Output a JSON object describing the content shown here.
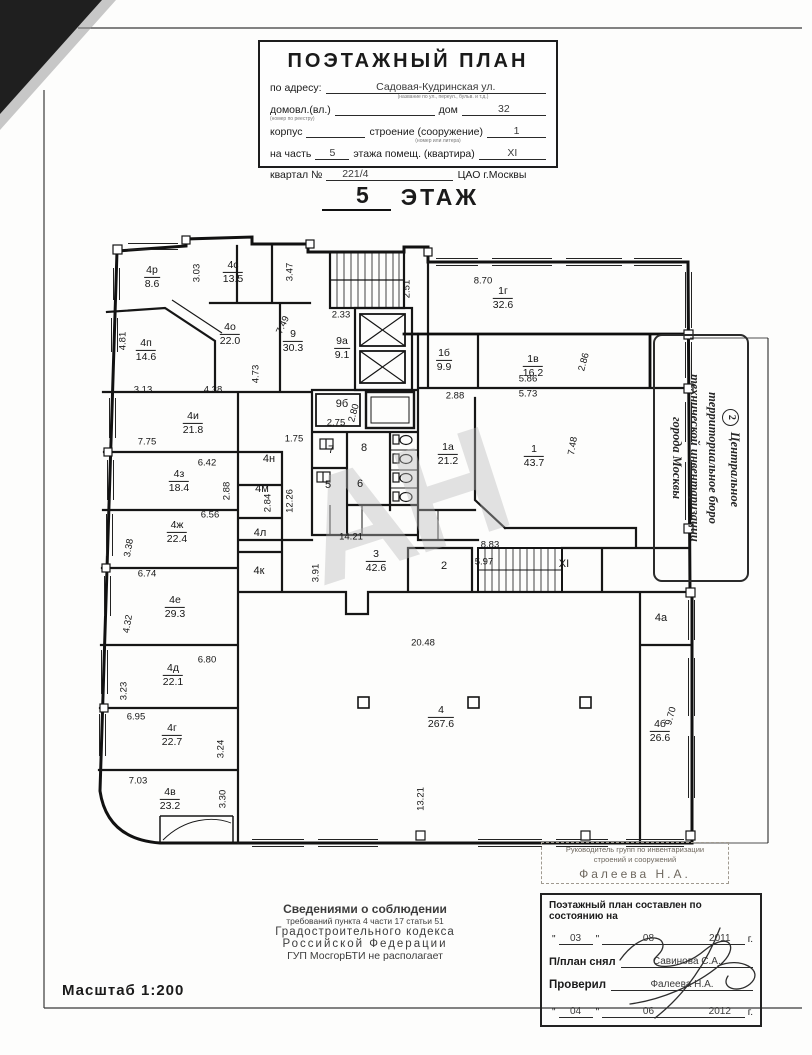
{
  "header": {
    "title": "ПОЭТАЖНЫЙ ПЛАН",
    "address_label": "по адресу:",
    "address_value": "Садовая-Кудринская ул.",
    "note1": "(название по ул., переул., бульв. и т.д.)",
    "row2_label1": "домовл.(вл.)",
    "note2": "(номер по реестру)",
    "row2_label2": "дом",
    "row2_value": "32",
    "row3_label1": "корпус",
    "row3_label2": "строение (сооружение)",
    "row3_value": "1",
    "note3": "(номер или литера)",
    "row4_label1": "на часть",
    "row4_value1": "5",
    "row4_label2": "этажа помещ. (квартира)",
    "row4_value2": "XI",
    "row5_label1": "квартал №",
    "row5_value1": "221/4",
    "row5_value2": "ЦАО г.Москвы"
  },
  "floor_title": {
    "num": "5",
    "word": "ЭТАЖ"
  },
  "stamp_right": {
    "number": "2",
    "line1": "Центральное",
    "line2": "территориальное бюро",
    "line3": "технической инвентаризации",
    "line4": "города Москвы"
  },
  "note": {
    "line1": "Сведениями о соблюдении",
    "line2": "требований пункта 4 части 17 статьи 51",
    "line3": "Градостроительного кодекса",
    "line4": "Российской Федерации",
    "line5": "ГУП МосгорБТИ не располагает"
  },
  "stamp_small": {
    "line1": "Руководитель групп по инвентаризации",
    "line2": "строений и сооружений",
    "line3": "Фалеева Н.А."
  },
  "sign_box": {
    "title": "Поэтажный план составлен по состоянию на",
    "q": "\"",
    "date1_day": "03",
    "date1_month": "08",
    "date1_year": "2011",
    "date1_suffix": "г.",
    "row1_label": "П/план снял",
    "row1_value": "Савинова С.А.",
    "row2_label": "Проверил",
    "row2_value": "Фалеева Н.А.",
    "date2_day": "04",
    "date2_month": "06",
    "date2_year": "2012",
    "date2_suffix": "г."
  },
  "scale_label": "Масштаб 1:200",
  "plan": {
    "watermark": "АН",
    "rooms": [
      {
        "id": "4р",
        "area": "8.6",
        "x": 152,
        "y": 277
      },
      {
        "id": "4с",
        "area": "13.5",
        "x": 233,
        "y": 272
      },
      {
        "id": "4п",
        "area": "14.6",
        "x": 146,
        "y": 350
      },
      {
        "id": "4о",
        "area": "22.0",
        "x": 230,
        "y": 334
      },
      {
        "id": "9",
        "area": "30.3",
        "x": 293,
        "y": 341
      },
      {
        "id": "9а",
        "area": "9.1",
        "x": 342,
        "y": 348
      },
      {
        "id": "1г",
        "area": "32.6",
        "x": 503,
        "y": 298
      },
      {
        "id": "1б",
        "area": "9.9",
        "x": 444,
        "y": 360
      },
      {
        "id": "1в",
        "area": "16.2",
        "x": 533,
        "y": 366
      },
      {
        "id": "4и",
        "area": "21.8",
        "x": 193,
        "y": 423
      },
      {
        "id": "1а",
        "area": "21.2",
        "x": 448,
        "y": 454
      },
      {
        "id": "1",
        "area": "43.7",
        "x": 534,
        "y": 456
      },
      {
        "id": "4з",
        "area": "18.4",
        "x": 179,
        "y": 481
      },
      {
        "id": "4ж",
        "area": "22.4",
        "x": 177,
        "y": 532
      },
      {
        "id": "3",
        "area": "42.6",
        "x": 376,
        "y": 561
      },
      {
        "id": "4е",
        "area": "29.3",
        "x": 175,
        "y": 607
      },
      {
        "id": "4д",
        "area": "22.1",
        "x": 173,
        "y": 675
      },
      {
        "id": "4г",
        "area": "22.7",
        "x": 172,
        "y": 735
      },
      {
        "id": "4в",
        "area": "23.2",
        "x": 170,
        "y": 799
      },
      {
        "id": "4",
        "area": "267.6",
        "x": 441,
        "y": 717
      },
      {
        "id": "4б",
        "area": "26.6",
        "x": 660,
        "y": 731
      }
    ],
    "labels": [
      {
        "text": "4н",
        "x": 269,
        "y": 459
      },
      {
        "text": "4м",
        "x": 262,
        "y": 489
      },
      {
        "text": "4л",
        "x": 260,
        "y": 533
      },
      {
        "text": "4к",
        "x": 259,
        "y": 571
      },
      {
        "text": "9б",
        "x": 342,
        "y": 404
      },
      {
        "text": "7",
        "x": 331,
        "y": 450
      },
      {
        "text": "8",
        "x": 364,
        "y": 448
      },
      {
        "text": "5",
        "x": 328,
        "y": 485
      },
      {
        "text": "6",
        "x": 360,
        "y": 484
      },
      {
        "text": "2",
        "x": 444,
        "y": 566
      },
      {
        "text": "XI",
        "x": 564,
        "y": 564
      },
      {
        "text": "4а",
        "x": 661,
        "y": 618
      }
    ],
    "dims": [
      {
        "text": "3.03",
        "x": 197,
        "y": 273,
        "rot": -90
      },
      {
        "text": "3.47",
        "x": 290,
        "y": 272,
        "rot": -90
      },
      {
        "text": "2.51",
        "x": 407,
        "y": 289,
        "rot": -90
      },
      {
        "text": "8.70",
        "x": 483,
        "y": 281,
        "rot": 0
      },
      {
        "text": "2.33",
        "x": 341,
        "y": 315,
        "rot": 0
      },
      {
        "text": "7.49",
        "x": 283,
        "y": 325,
        "rot": -65
      },
      {
        "text": "4.81",
        "x": 123,
        "y": 341,
        "rot": -90
      },
      {
        "text": "3.13",
        "x": 143,
        "y": 390,
        "rot": 0
      },
      {
        "text": "4.38",
        "x": 213,
        "y": 390,
        "rot": 0
      },
      {
        "text": "4.73",
        "x": 256,
        "y": 374,
        "rot": -90
      },
      {
        "text": "2.86",
        "x": 584,
        "y": 362,
        "rot": -75
      },
      {
        "text": "5.86",
        "x": 528,
        "y": 379,
        "rot": 0
      },
      {
        "text": "5.73",
        "x": 528,
        "y": 394,
        "rot": 0
      },
      {
        "text": "2.88",
        "x": 455,
        "y": 396,
        "rot": 0
      },
      {
        "text": "7.75",
        "x": 147,
        "y": 442,
        "rot": 0
      },
      {
        "text": "1.75",
        "x": 294,
        "y": 439,
        "rot": 0
      },
      {
        "text": "2.75",
        "x": 336,
        "y": 423,
        "rot": 0
      },
      {
        "text": "2.80",
        "x": 354,
        "y": 413,
        "rot": -75
      },
      {
        "text": "7.48",
        "x": 573,
        "y": 446,
        "rot": -80
      },
      {
        "text": "6.42",
        "x": 207,
        "y": 463,
        "rot": 0
      },
      {
        "text": "2.88",
        "x": 227,
        "y": 491,
        "rot": -90
      },
      {
        "text": "12.26",
        "x": 290,
        "y": 501,
        "rot": -90
      },
      {
        "text": "2.84",
        "x": 268,
        "y": 503,
        "rot": -90
      },
      {
        "text": "6.56",
        "x": 210,
        "y": 515,
        "rot": 0
      },
      {
        "text": "3.38",
        "x": 129,
        "y": 548,
        "rot": -80
      },
      {
        "text": "6.74",
        "x": 147,
        "y": 574,
        "rot": 0
      },
      {
        "text": "14.21",
        "x": 351,
        "y": 537,
        "rot": 0
      },
      {
        "text": "3.91",
        "x": 316,
        "y": 573,
        "rot": -90
      },
      {
        "text": "8.83",
        "x": 490,
        "y": 545,
        "rot": 0
      },
      {
        "text": "5.97",
        "x": 484,
        "y": 562,
        "rot": 0
      },
      {
        "text": "4.32",
        "x": 128,
        "y": 624,
        "rot": -80
      },
      {
        "text": "6.80",
        "x": 207,
        "y": 660,
        "rot": 0
      },
      {
        "text": "3.23",
        "x": 124,
        "y": 691,
        "rot": -90
      },
      {
        "text": "6.95",
        "x": 136,
        "y": 717,
        "rot": 0
      },
      {
        "text": "3.24",
        "x": 221,
        "y": 749,
        "rot": -90
      },
      {
        "text": "7.03",
        "x": 138,
        "y": 781,
        "rot": 0
      },
      {
        "text": "3.30",
        "x": 223,
        "y": 799,
        "rot": -90
      },
      {
        "text": "20.48",
        "x": 423,
        "y": 643,
        "rot": 0
      },
      {
        "text": "13.21",
        "x": 421,
        "y": 799,
        "rot": -90
      },
      {
        "text": "9.70",
        "x": 671,
        "y": 716,
        "rot": -75
      }
    ]
  }
}
